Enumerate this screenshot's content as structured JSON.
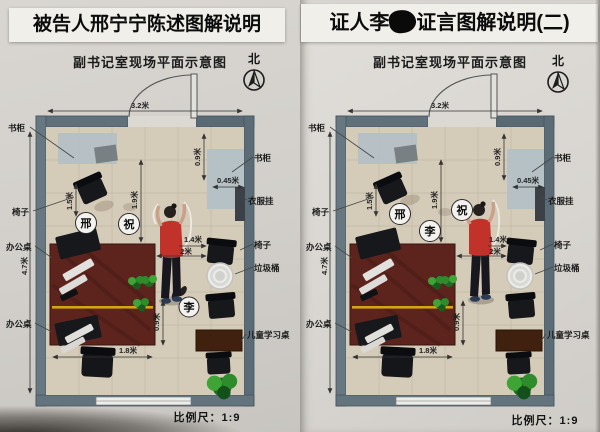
{
  "panels": [
    {
      "title": "被告人邢宁宁陈述图解说明",
      "subtitle": "副书记室现场平面示意图",
      "north_label": "北",
      "scale_label": "比例尺：1:9",
      "markers": {
        "xing": "邢",
        "zhu": "祝",
        "li": "李"
      },
      "labels": {
        "bookcase_left": "书柜",
        "bookcase_right": "书柜",
        "clothes_rack": "衣服挂",
        "chair_left": "椅子",
        "chair_right": "椅子",
        "office_desk_upper": "办公桌",
        "office_desk_lower": "办公桌",
        "trash_bin": "垃圾桶",
        "kids_desk": "儿童学习桌"
      },
      "dims": {
        "room_width": "3.2米",
        "room_height": "4.7米",
        "bookcase_depth": "0.9米",
        "bookcase_offset": "0.45米",
        "chair_dist": "1.5米",
        "door_dist": "1.9米",
        "person_to_chair": "1.4米",
        "desk_to_chair": "2米",
        "desk_width": "1.8米",
        "desk_offset": "0.9米"
      }
    },
    {
      "title_prefix": "证人李",
      "title_suffix": "证言图解说明(二)",
      "subtitle": "副书记室现场平面示意图",
      "north_label": "北",
      "scale_label": "比例尺：1:9",
      "markers": {
        "xing": "邢",
        "li": "李",
        "zhu": "祝"
      },
      "labels": {
        "bookcase_left": "书柜",
        "bookcase_right": "书柜",
        "clothes_rack": "衣服挂",
        "chair_left": "椅子",
        "chair_right": "椅子",
        "office_desk_upper": "办公桌",
        "office_desk_lower": "办公桌",
        "trash_bin": "垃圾桶",
        "kids_desk": "儿童学习桌"
      },
      "dims": {
        "room_width": "3.2米",
        "room_height": "4.7米",
        "bookcase_depth": "0.9米",
        "bookcase_offset": "0.45米",
        "chair_dist": "1.5米",
        "door_dist": "1.9米",
        "person_to_chair": "1.4米",
        "desk_to_chair": "2米",
        "desk_width": "1.8米",
        "desk_offset": "0.9米"
      }
    }
  ],
  "colors": {
    "wall": "#61717c",
    "floor": "#d5cbb9",
    "desk": "#5d241e",
    "desk_stripe": "#d3a512",
    "person_shirt": "#c1322a",
    "bookcase_area": "#b3bfc7",
    "kids_desk": "#40200f",
    "plant": "#2f8c2c",
    "paper": "#d6d3ce"
  }
}
